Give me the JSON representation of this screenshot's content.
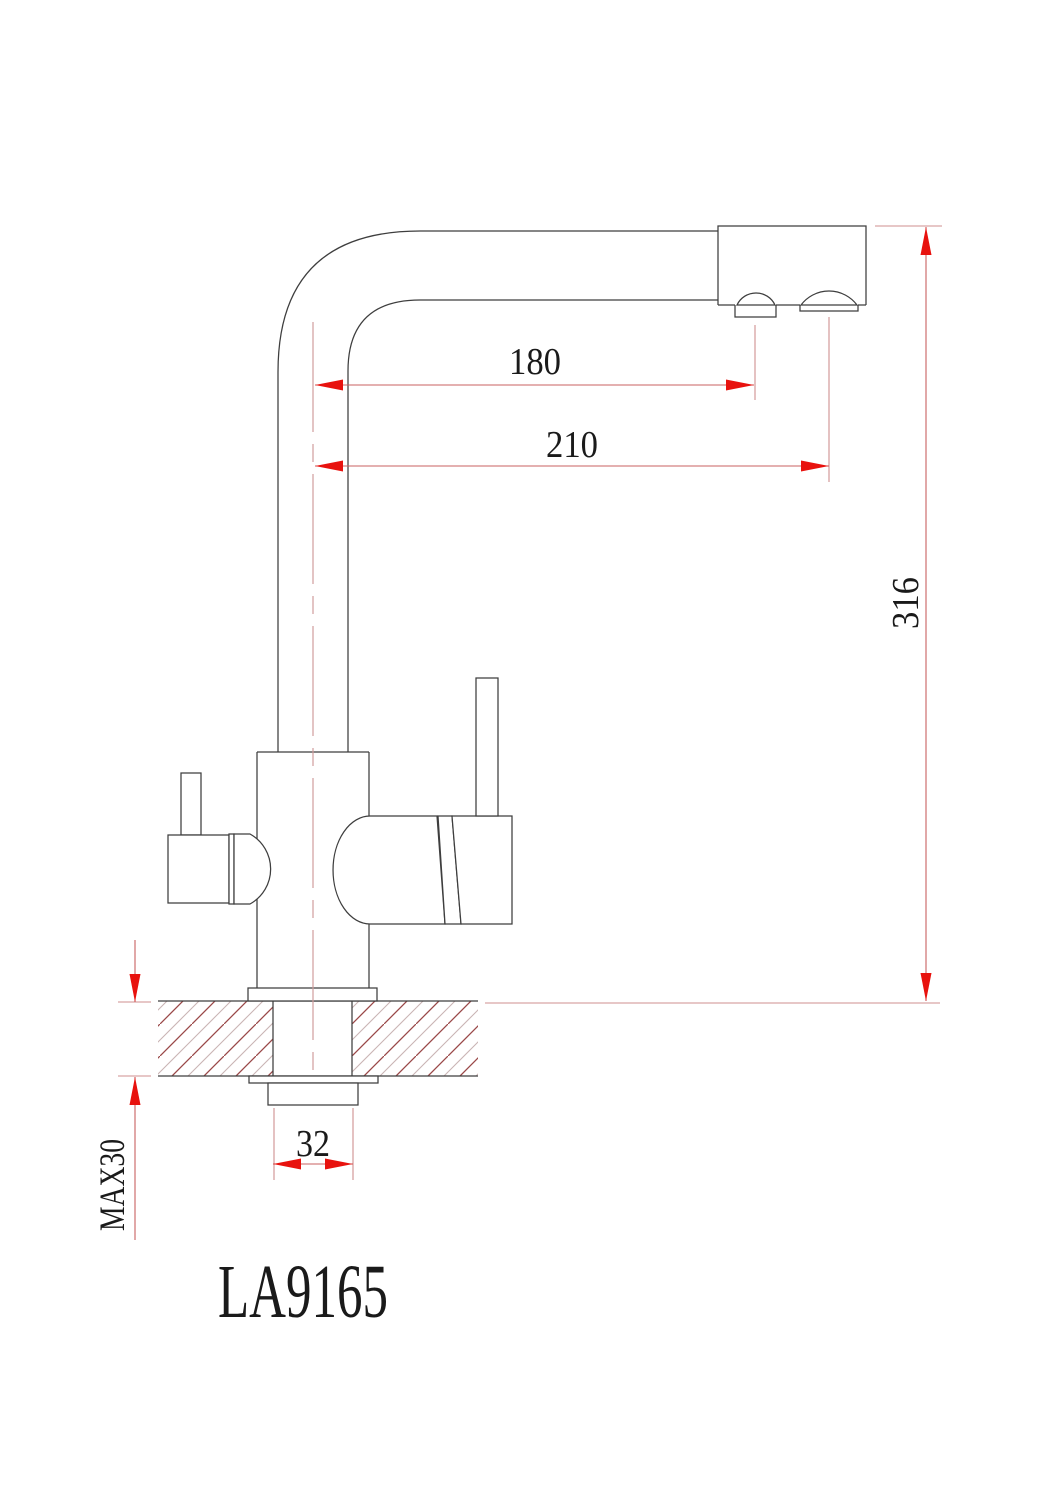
{
  "drawing": {
    "model_label": "LA9165",
    "dimensions": {
      "spout_reach_primary": {
        "label": "180"
      },
      "spout_reach_secondary": {
        "label": "210"
      },
      "spout_height": {
        "label": "316"
      },
      "shank_diameter": {
        "label": "32"
      },
      "max_counter_thickness": {
        "label": "MAX30"
      }
    },
    "colors": {
      "outline": "#3e3e3e",
      "dimension_line": "#c86060",
      "extension_line": "#cf8f8f",
      "centerline": "#d09c9c",
      "arrow": "#e8120e",
      "hatch_dark": "#9a4848",
      "hatch_light": "#c9b4b4",
      "text": "#1a1a1a",
      "background": "#ffffff"
    }
  }
}
